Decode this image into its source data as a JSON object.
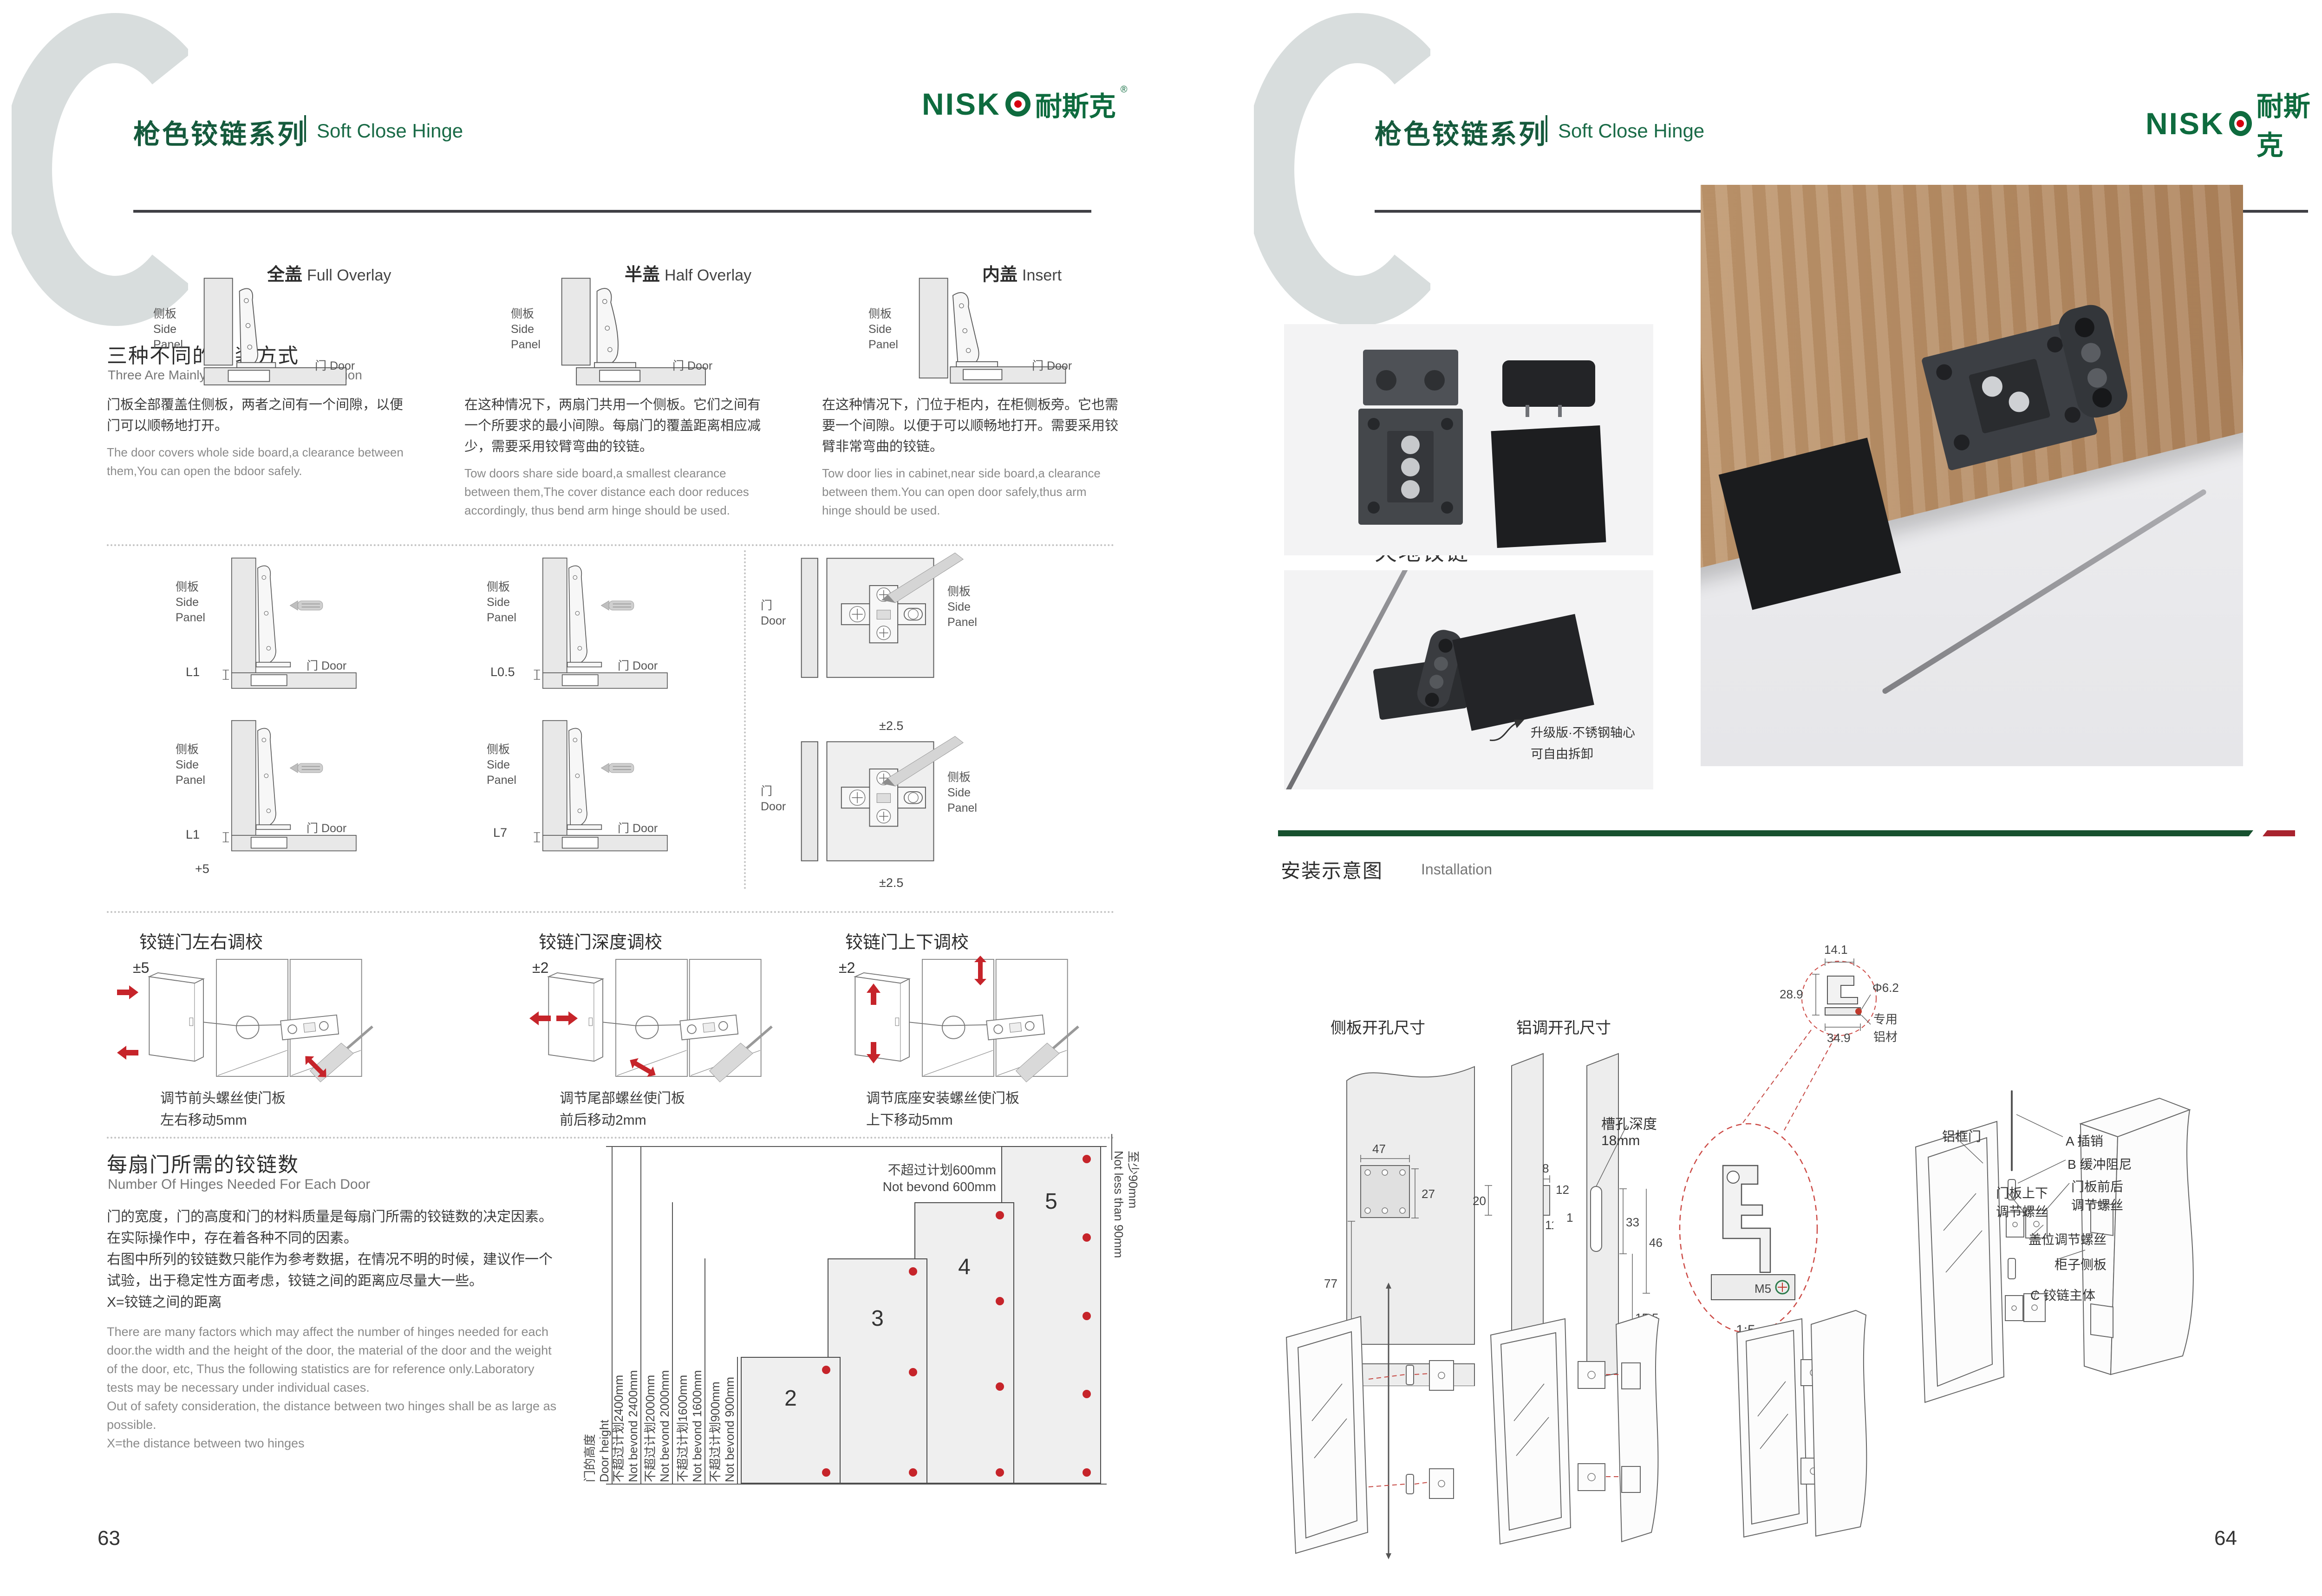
{
  "deco": {
    "c": "C"
  },
  "brand": {
    "name": "NISK",
    "cn": "耐斯克",
    "reg": "®"
  },
  "header": {
    "series_cn": "枪色铰链系列",
    "series_en": "Soft Close Hinge"
  },
  "pages": {
    "left": "63",
    "right": "64"
  },
  "labels": {
    "side_cn": "侧板",
    "side_en1": "Side",
    "side_en2": "Panel",
    "door_cn": "门",
    "door_en": "Door"
  },
  "ways": {
    "title_cn": "三种不同的安装方式",
    "title_en": "Three Are Mainly Three Ways Of Installation",
    "cols": [
      {
        "cn": "全盖",
        "en": "Full Overlay",
        "desc_cn": "门板全部覆盖住侧板，两者之间有一个间隙，以便门可以顺畅地打开。",
        "desc_en": "The door covers whole side board,a clearance between them,You can open the bdoor safely."
      },
      {
        "cn": "半盖",
        "en": "Half Overlay",
        "desc_cn": "在这种情况下，两扇门共用一个侧板。它们之间有一个所要求的最小间隙。每扇门的覆盖距离相应减少，需要采用铰臂弯曲的铰链。",
        "desc_en": "Tow doors share side board,a smallest clearance between them,The cover distance each door reduces accordingly, thus bend arm hinge should be used."
      },
      {
        "cn": "内盖",
        "en": "Insert",
        "desc_cn": "在这种情况下，门位于柜内，在柜侧板旁。它也需要一个间隙。以便于可以顺畅地打开。需要采用铰臂非常弯曲的铰链。",
        "desc_en": "Tow door lies in cabinet,near side board,a clearance between them.You can open door safely,thus arm hinge should be used."
      }
    ]
  },
  "gaps": {
    "l1a": "L1",
    "l05": "L0.5",
    "l1b": "L1",
    "l7": "L7",
    "plus5": "+5",
    "pm25_top": "±2.5",
    "pm25_bottom": "±2.5"
  },
  "adjust": {
    "cols": [
      {
        "title": "铰链门左右调校",
        "range": "±5",
        "cap1": "调节前头螺丝使门板",
        "cap2": "左右移动5mm"
      },
      {
        "title": "铰链门深度调校",
        "range": "±2",
        "cap1": "调节尾部螺丝使门板",
        "cap2": "前后移动2mm"
      },
      {
        "title": "铰链门上下调校",
        "range": "±2",
        "cap1": "调节底座安装螺丝使门板",
        "cap2": "上下移动5mm"
      }
    ]
  },
  "hinges": {
    "title_cn": "每扇门所需的铰链数",
    "title_en": "Number Of Hinges Needed For Each Door",
    "desc_cn": [
      "门的宽度，门的高度和门的材料质量是每扇门所需的铰链数的决定因素。",
      "在实际操作中，存在着各种不同的因素。",
      "右图中所列的铰链数只能作为参考数据，在情况不明的时候，建议作一个",
      "试验，出于稳定性方面考虑，铰链之间的距离应尽量大一些。",
      "X=铰链之间的距离"
    ],
    "desc_en": [
      "There are many factors which may affect the number of hinges needed for each",
      "door.the width and the height of the door, the material of the door and the weight",
      "of the door, etc, Thus the following statistics are for reference only.Laboratory",
      "tests may be necessary under individual cases.",
      "Out of safety consideration, the distance between two hinges shall be as large as",
      "possible.",
      "X=the distance between two hinges"
    ]
  },
  "chart_data": {
    "type": "bar",
    "title_cn": "每扇门所需的铰链数",
    "title_en": "Number Of Hinges Needed For Each Door",
    "ylabel_cn": "门的高度",
    "ylabel_en": "Door height",
    "categories": [
      "2",
      "3",
      "4",
      "5"
    ],
    "values": [
      2,
      3,
      4,
      5
    ],
    "bars": [
      {
        "hinges": 2,
        "max_height_mm": 900,
        "label_cn": "不超过计划900mm",
        "label_en": "Not bevond 900mm"
      },
      {
        "hinges": 3,
        "max_height_mm": 1600,
        "label_cn": "不超过计划1600mm",
        "label_en": "Not bevond 1600mm"
      },
      {
        "hinges": 4,
        "max_height_mm": 2000,
        "label_cn": "不超过计划2000mm",
        "label_en": "Not bevond 2000mm"
      },
      {
        "hinges": 5,
        "max_height_mm": 2400,
        "label_cn": "不超过计划2400mm",
        "label_en": "Not bevond 2400mm"
      }
    ],
    "width_limit_cn": "不超过计划600mm",
    "width_limit_en": "Not bevond 600mm",
    "edge_min_cn": "至少90mm",
    "edge_min_en": "Not less than 90mm"
  },
  "product": {
    "code": "AL01",
    "name_cn": "天地铰链",
    "name_en": "Air Hinge",
    "note1": "升级版·不锈钢轴心",
    "note2": "可自由拆卸"
  },
  "install": {
    "title_cn": "安装示意图",
    "title_en": "Installation",
    "side_title": "侧板开孔尺寸",
    "alu_title": "铝调开孔尺寸",
    "slot_cn": "槽孔深度",
    "slot_mm": "18mm",
    "d47": "47",
    "d27": "27",
    "d77": "77",
    "d25": "25",
    "d8": "8",
    "d20": "20",
    "d11": "11",
    "d12": "12",
    "d1": "1",
    "d33": "33",
    "d46": "46",
    "d155": "15.5",
    "m5a": "M5",
    "m5b": "M5",
    "d141": "14.1",
    "d289": "28.9",
    "dphi": "Φ6.2",
    "d349": "34.9",
    "alu1": "专用",
    "alu2": "铝材",
    "scale": "1:5",
    "lab_frame": "铝框门",
    "lab_a": "A 插销",
    "lab_b": "B 缓冲阻尼",
    "lab_fb1": "门板前后",
    "lab_fb2": "调节螺丝",
    "lab_ud1": "门板上下",
    "lab_ud2": "调节螺丝",
    "lab_cover": "盖位调节螺丝",
    "lab_side": "柜子侧板",
    "lab_c": "C 铰链主体"
  }
}
